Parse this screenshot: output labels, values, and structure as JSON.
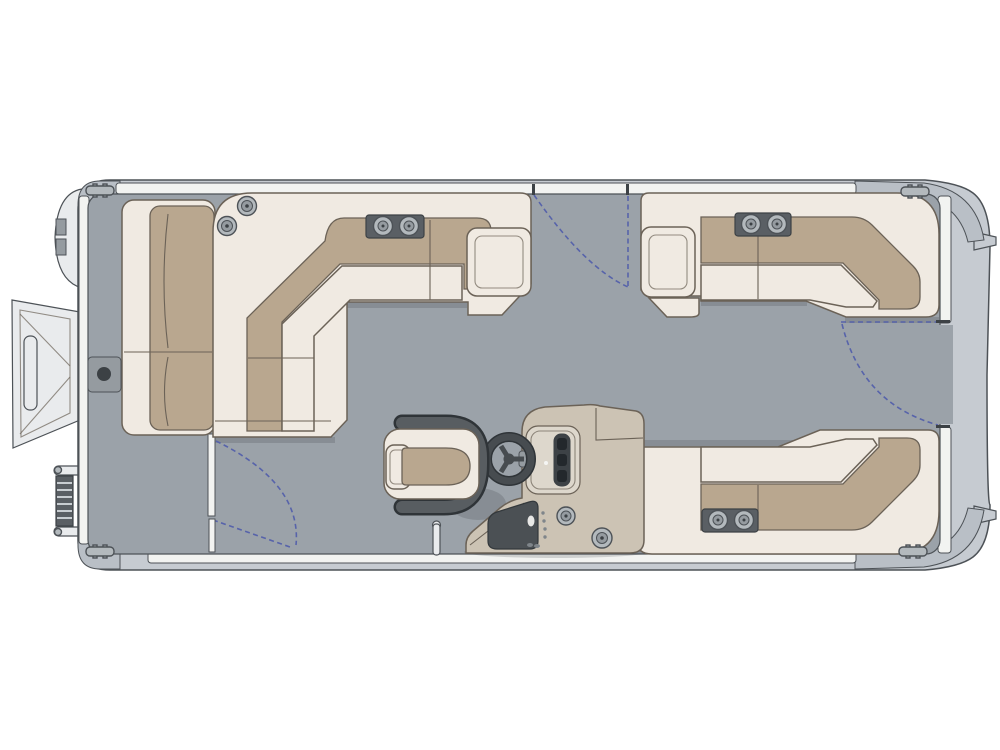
{
  "title": "pontoon-boat-floorplan-top-view",
  "palette": {
    "background": "#ffffff",
    "hull": "#c6cbd1",
    "hull_cap": "#b9bfc6",
    "fence": "#f2f3f1",
    "deck": "#9ba2a9",
    "upholstery_cream": "#f0eae2",
    "upholstery_tan": "#b9a78f",
    "trim_dark": "#5a5f64",
    "trim_darker": "#3c4145",
    "metal_light": "#e9ebed",
    "console_beige": "#ccc3b4",
    "dashboard": "#ddd7cc",
    "instrument_dark": "#3d4246",
    "gate_swing_blue": "#5763aa",
    "outline": "#4d5257",
    "sofa_outline": "#6b6257"
  },
  "diagram": {
    "type": "boat-floorplan",
    "orientation": "bow-left-stern-right",
    "components": [
      {
        "name": "bow-boarding-ramp"
      },
      {
        "name": "boarding-ladder"
      },
      {
        "name": "bow-lounge-seat"
      },
      {
        "name": "port-bow-l-lounge",
        "cup_holders": 2,
        "speakers": 2
      },
      {
        "name": "starboard-aft-l-lounge",
        "cup_holders": 2
      },
      {
        "name": "aft-l-lounge",
        "cup_holders": 2
      },
      {
        "name": "helm-console",
        "cup_holders": 2
      },
      {
        "name": "steering-wheel"
      },
      {
        "name": "captain-chair"
      },
      {
        "name": "bow-gate-swing"
      },
      {
        "name": "port-side-gate-swing"
      },
      {
        "name": "stern-gate-swing"
      },
      {
        "name": "cleats",
        "count": 4
      },
      {
        "name": "motor-mount-tabs",
        "count": 2
      }
    ]
  }
}
